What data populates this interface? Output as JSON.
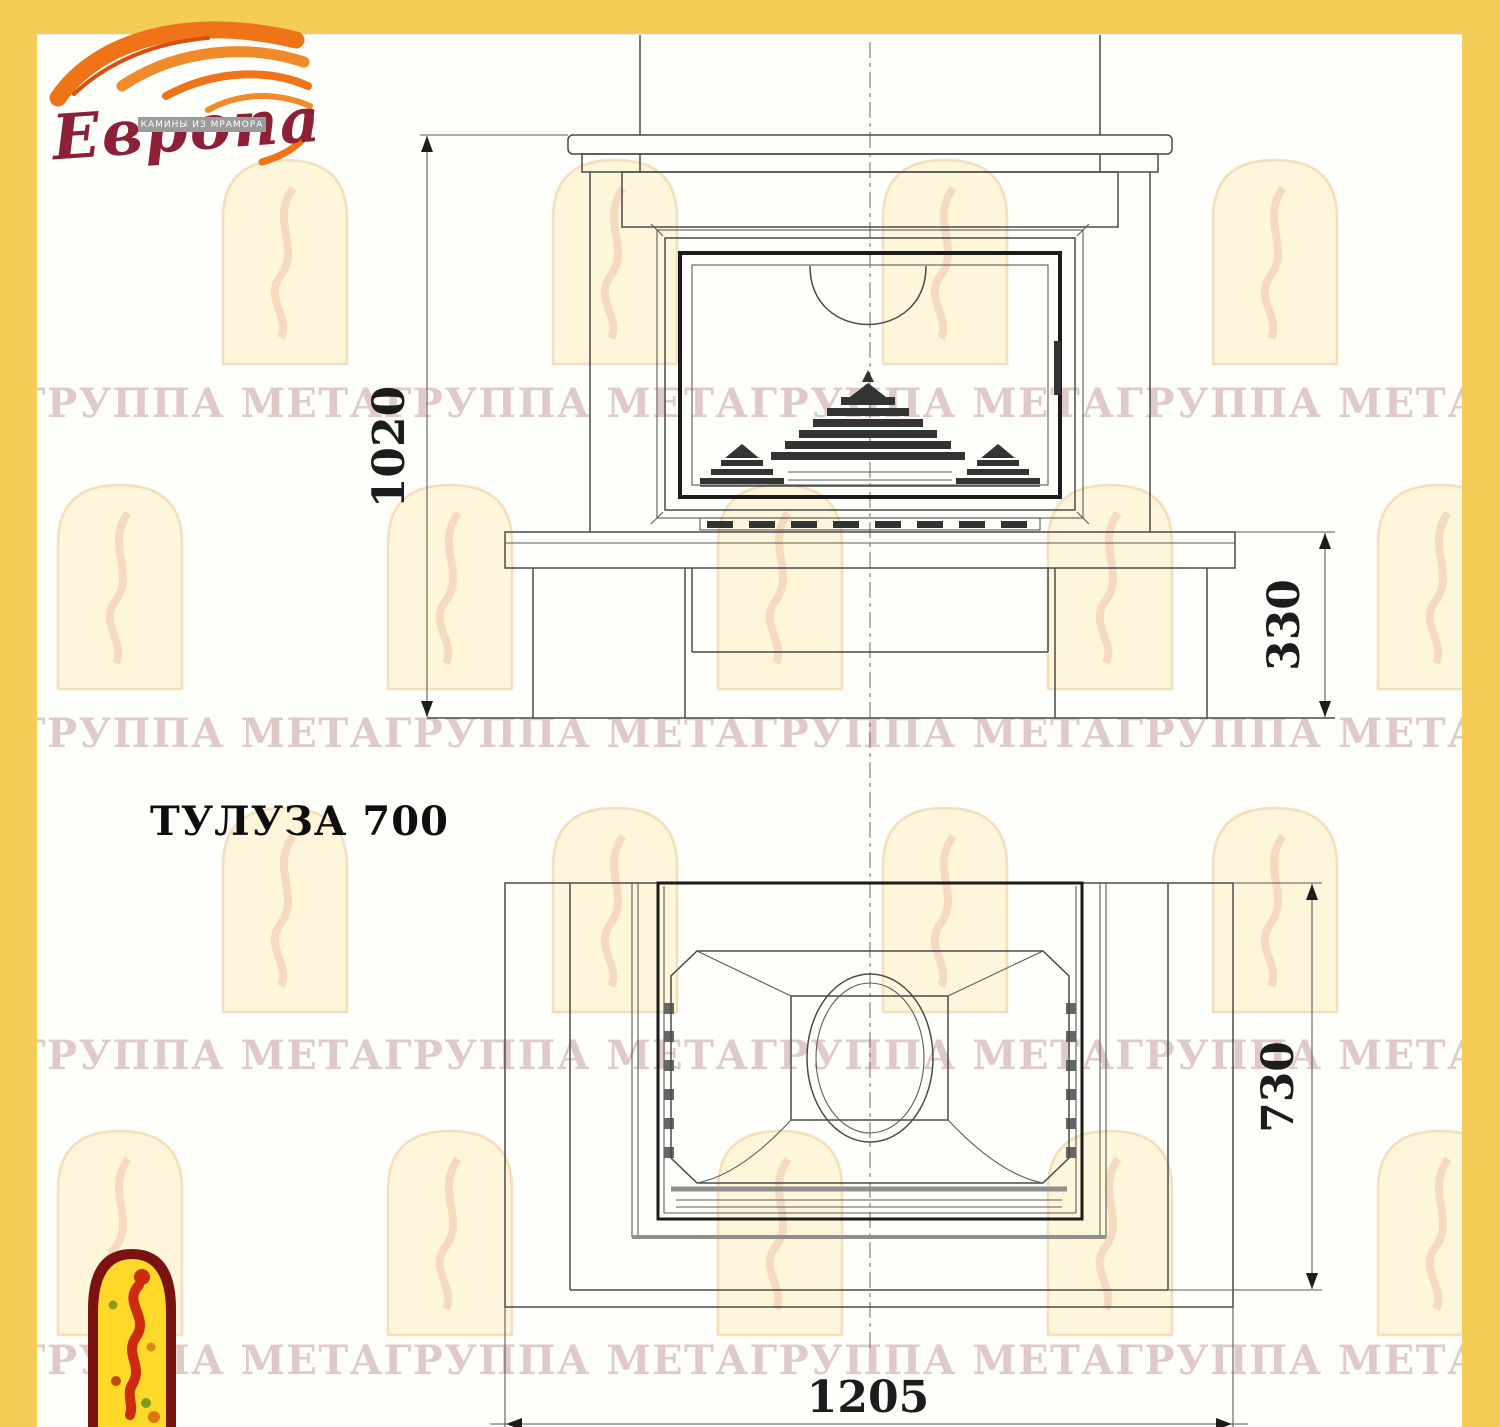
{
  "title": "ТУЛУЗА 700",
  "brand": {
    "name": "Европа",
    "tagline": "КАМИНЫ ИЗ МРАМОРА"
  },
  "watermark": {
    "text": "ГРУППА МЕТАГРУППА МЕТАГРУППА МЕТАГРУППА МЕТА"
  },
  "drawing": {
    "views": [
      {
        "name": "front view"
      },
      {
        "name": "plan view"
      }
    ],
    "dimensions": {
      "front_height": "1020",
      "base_height": "330",
      "depth": "730",
      "width": "1205"
    }
  },
  "colors": {
    "frame_yellow": "#F3CD56",
    "logo_red": "#8C2038",
    "flame_orange": "#EE7417",
    "line_gray": "#4a4a4a"
  }
}
